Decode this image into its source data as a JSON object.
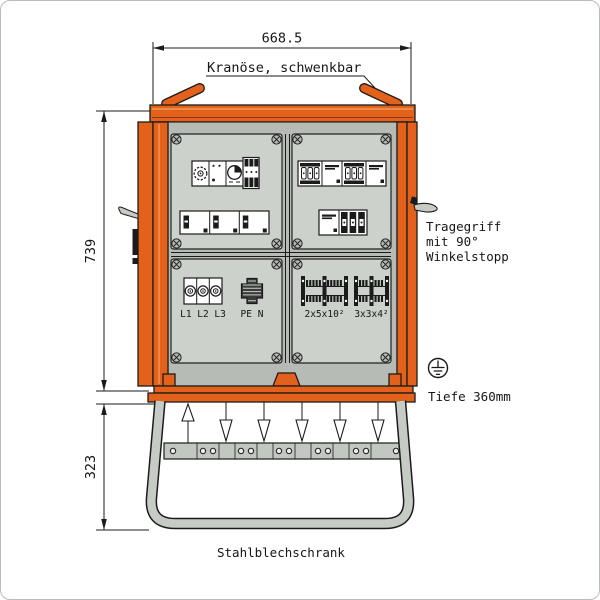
{
  "dimensions": {
    "width": "668.5",
    "height": "739",
    "base_height": "323"
  },
  "annotations": {
    "crane": "Kranöse, schwenkbar",
    "handle_line1": "Tragegriff",
    "handle_line2": "mit 90°",
    "handle_line3": "Winkelstopp",
    "depth": "Tiefe 360mm",
    "cabinet_type": "Stahlblechschrank"
  },
  "panel_labels": {
    "phases": "L1 L2 L3",
    "pe_n": "PE N",
    "terminal_group_left": "2x5x10²",
    "terminal_group_right": "3x3x4²"
  },
  "icons": {
    "crane_eye": "swivel-lifting-lug",
    "earth": "protective-earth-symbol",
    "handle": "side-carry-handle",
    "screw": "panel-screw-cross",
    "timer": "timer-dial-module",
    "meter": "meter-dial-module",
    "arrows": "cable-entry-arrows"
  },
  "colors": {
    "orange": "#E4611B",
    "orange_highlight": "#F09A5A",
    "outline": "#1B1B1B",
    "door_gray": "#B7BBB6",
    "panel_gray": "#CDD1CC",
    "tube_gray": "#C7CBC6",
    "rail_gray": "#C3C7C2"
  }
}
